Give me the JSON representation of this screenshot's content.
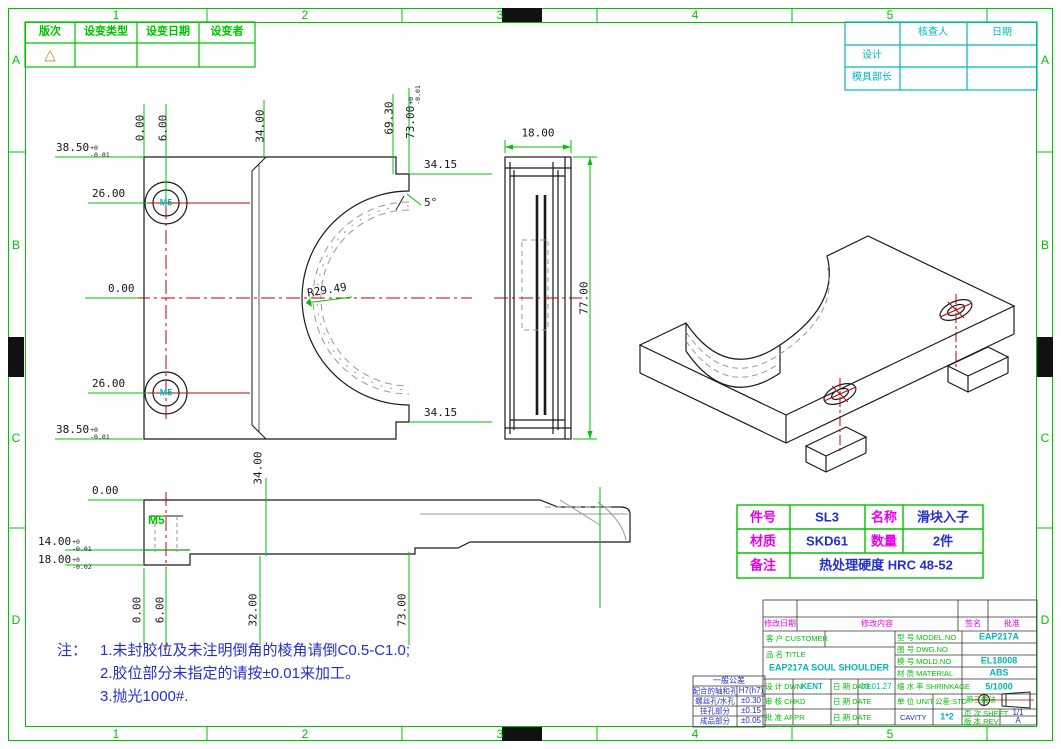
{
  "colors": {
    "green": "#00c300",
    "cyan": "#00b8b8",
    "magenta": "#e800e8",
    "blue": "#2330cc",
    "red": "#c00000",
    "orange": "#cc8833"
  },
  "border": {
    "cols": [
      "1",
      "2",
      "3",
      "4",
      "5"
    ],
    "rows": [
      "A",
      "B",
      "C",
      "D"
    ]
  },
  "revision_table": {
    "headers": [
      "版次",
      "设变类型",
      "设变日期",
      "设变者"
    ],
    "symbol": "△"
  },
  "approval_table": {
    "checker": "核查人",
    "date": "日期",
    "designer": "设计",
    "mold_chief": "模具部长"
  },
  "parts_table": {
    "part_no_label": "件号",
    "part_no": "SL3",
    "name_label": "名称",
    "name": "滑块入子",
    "material_label": "材质",
    "material": "SKD61",
    "qty_label": "数量",
    "qty": "2件",
    "remark_label": "备注",
    "remark": "热处理硬度 HRC 48-52"
  },
  "notes": {
    "prefix": "注：",
    "line1": "1.未封胶位及未注明倒角的棱角请倒C0.5-C1.0;",
    "line2": "2.胶位部分未指定的请按±0.01来加工。",
    "line3": "3.抛光1000#."
  },
  "tolerance_table": {
    "title": "一般公差",
    "rows": [
      [
        "配合的轴和孔",
        "H7(h7)"
      ],
      [
        "螺丝孔/水孔",
        "±0.30"
      ],
      [
        "挂孔部分",
        "±0.15"
      ],
      [
        "成品部分",
        "±0.05"
      ]
    ]
  },
  "title_block": {
    "rev_date": "修改日期",
    "rev_content": "修改内容",
    "rev_sign": "签名",
    "rev_appr": "批准",
    "customer_label": "客 户 CUSTOMER",
    "customer": "",
    "title_label": "品 名 TITLE",
    "title_value": "EAP217A SOUL SHOULDER",
    "model_label": "型 号 MODEL.NO",
    "model": "EAP217A",
    "dwg_label": "图 号 DWG.NO",
    "dwg": "",
    "mold_label": "模 号 MOLD.NO",
    "mold": "EL18008",
    "mat_label": "材 质 MATERIAL",
    "mat": "ABS",
    "dwn_label": "设 计 DWN",
    "dwn": "KENT",
    "dwn_date_label": "日 期 DATE",
    "dwn_date": "18.01.27",
    "chk_label": "审 核 CHKD",
    "chk": "",
    "chk_date_label": "日 期 DATE",
    "chk_date": "",
    "appr_label": "批 准 APPR",
    "appr": "",
    "appr_date_label": "日 期 DATE",
    "appr_date": "",
    "shrink_label": "缩 水 率 SHRINKAGE",
    "shrink": "5/1000",
    "unit_label": "单 位 UNIT",
    "unit_std": "公差:STD",
    "cavity_label": "CAVITY",
    "cavity": "1*2",
    "angle_label": "第三角法",
    "sheet_label": "页 次 SHEET",
    "sheet": "1/1",
    "rev_label": "版 本 REV",
    "rev": "A"
  },
  "dims": [
    {
      "t": "38.50",
      "tu": "+0",
      "td": "-0.01"
    },
    {
      "t": "26.00"
    },
    {
      "t": "0.00"
    },
    {
      "t": "26.00"
    },
    {
      "t": "38.50",
      "tu": "+0",
      "td": "-0.01"
    },
    {
      "t": "0.00"
    },
    {
      "t": "6.00"
    },
    {
      "t": "34.00"
    },
    {
      "t": "69.30"
    },
    {
      "t": "73.00",
      "tu": "+0",
      "td": "-0.01"
    },
    {
      "t": "34.15"
    },
    {
      "t": "5°"
    },
    {
      "t": "R29.49"
    },
    {
      "t": "34.15"
    },
    {
      "t": "M5"
    },
    {
      "t": "M5"
    },
    {
      "t": "18.00"
    },
    {
      "t": "77.00"
    },
    {
      "t": "0.00"
    },
    {
      "t": "14.00",
      "tu": "+0",
      "td": "-0.01"
    },
    {
      "t": "18.00",
      "tu": "+0",
      "td": "-0.02"
    },
    {
      "t": "M5"
    },
    {
      "t": "34.00"
    },
    {
      "t": "0.00"
    },
    {
      "t": "6.00"
    },
    {
      "t": "32.00"
    },
    {
      "t": "73.00"
    }
  ]
}
